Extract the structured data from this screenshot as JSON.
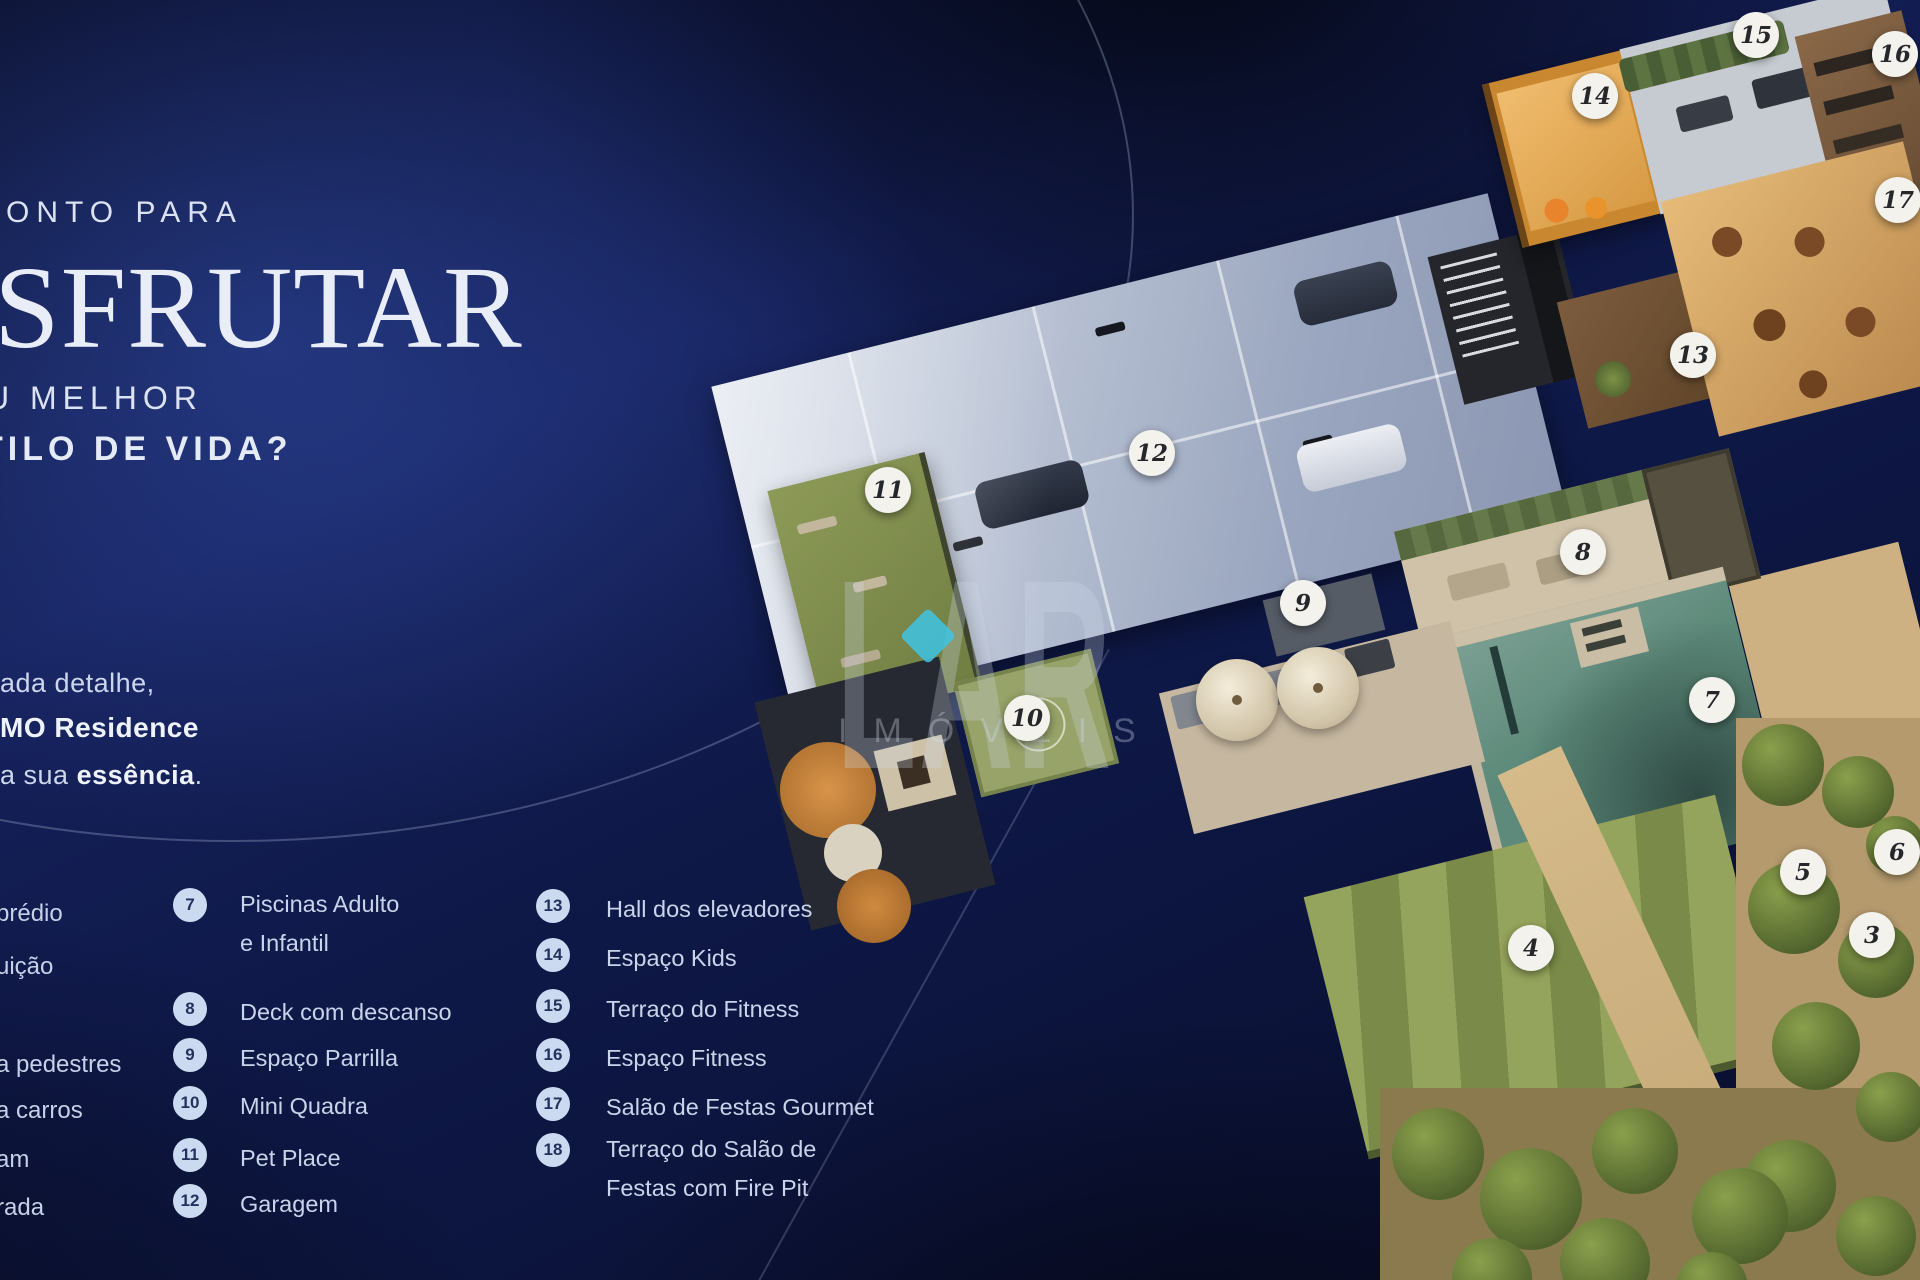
{
  "headline": {
    "line1": "ONTO PARA",
    "line2": "SFRUTAR",
    "line3": "U MELHOR",
    "line4": "TILO DE VIDA?"
  },
  "paragraph": {
    "line1": "ada detalhe,",
    "line2": "MO Residence",
    "line3_pre": "a sua ",
    "line3_bold": "essência",
    "line3_post": "."
  },
  "legend": {
    "col1": [
      "prédio",
      "uição",
      "a pedestres",
      "a carros",
      "am",
      "rada"
    ],
    "col2": [
      {
        "num": "7",
        "label": "Piscinas Adulto\ne Infantil"
      },
      {
        "num": "8",
        "label": "Deck com descanso"
      },
      {
        "num": "9",
        "label": "Espaço Parrilla"
      },
      {
        "num": "10",
        "label": "Mini Quadra"
      },
      {
        "num": "11",
        "label": "Pet Place"
      },
      {
        "num": "12",
        "label": "Garagem"
      }
    ],
    "col3": [
      {
        "num": "13",
        "label": "Hall dos elevadores"
      },
      {
        "num": "14",
        "label": "Espaço Kids"
      },
      {
        "num": "15",
        "label": "Terraço do Fitness"
      },
      {
        "num": "16",
        "label": "Espaço Fitness"
      },
      {
        "num": "17",
        "label": "Salão de Festas Gourmet"
      },
      {
        "num": "18",
        "label": "Terraço do Salão de\nFestas com Fire Pit"
      }
    ]
  },
  "watermark": {
    "brand": "LAR",
    "sub": "IMÓVEIS",
    "diamond_color": "#3ec4e4"
  },
  "plan": {
    "markers": [
      {
        "num": "3"
      },
      {
        "num": "4"
      },
      {
        "num": "5"
      },
      {
        "num": "6"
      },
      {
        "num": "7"
      },
      {
        "num": "8"
      },
      {
        "num": "9"
      },
      {
        "num": "10"
      },
      {
        "num": "11"
      },
      {
        "num": "12"
      },
      {
        "num": "13"
      },
      {
        "num": "14"
      },
      {
        "num": "15"
      },
      {
        "num": "16"
      },
      {
        "num": "17"
      }
    ]
  },
  "colors": {
    "background_navy": "#0d1744",
    "accent_cyan": "#3ec4e4",
    "badge_bg": "#ccdaf1",
    "badge_text": "#22325c",
    "marker_bg": "#f3f2ec",
    "marker_text": "#26272b",
    "pool_teal": "#5d8a7a",
    "lawn_green": "#8a9a52",
    "terrace_amber": "#cf9a5a",
    "garage_grey": "#a9b4c9"
  }
}
